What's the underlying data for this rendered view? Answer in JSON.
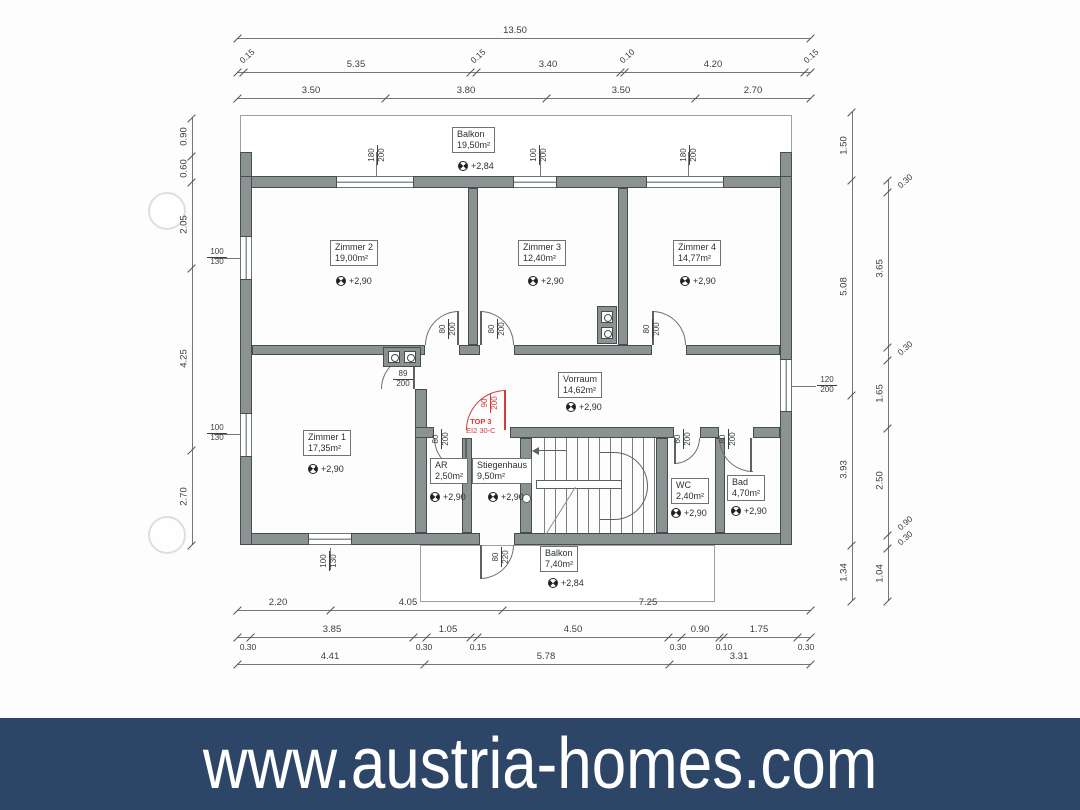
{
  "banner": {
    "text": "www.austria-homes.com",
    "bg_color": "#2d4668",
    "text_color": "#ffffff"
  },
  "colors": {
    "red_accent": "#d43a3a",
    "wall_gray": "#8b9292"
  },
  "rooms": [
    {
      "name": "Balkon",
      "area": "19,50m²",
      "bx": 452,
      "by": 127,
      "lvl": "+2,84",
      "lx": 458,
      "ly": 161
    },
    {
      "name": "Zimmer 2",
      "area": "19,00m²",
      "bx": 330,
      "by": 240,
      "lvl": "+2,90",
      "lx": 336,
      "ly": 276
    },
    {
      "name": "Zimmer 3",
      "area": "12,40m²",
      "bx": 518,
      "by": 240,
      "lvl": "+2,90",
      "lx": 528,
      "ly": 276
    },
    {
      "name": "Zimmer 4",
      "area": "14,77m²",
      "bx": 673,
      "by": 240,
      "lvl": "+2,90",
      "lx": 680,
      "ly": 276
    },
    {
      "name": "Vorraum",
      "area": "14,62m²",
      "bx": 558,
      "by": 372,
      "lvl": "+2,90",
      "lx": 566,
      "ly": 402
    },
    {
      "name": "Zimmer 1",
      "area": "17,35m²",
      "bx": 303,
      "by": 430,
      "lvl": "+2,90",
      "lx": 308,
      "ly": 464
    },
    {
      "name": "AR",
      "area": "2,50m²",
      "bx": 430,
      "by": 458,
      "lvl": "+2,90",
      "lx": 430,
      "ly": 492
    },
    {
      "name": "Stiegenhaus",
      "area": "9,50m²",
      "bx": 472,
      "by": 458,
      "lvl": "+2,90",
      "lx": 488,
      "ly": 492
    },
    {
      "name": "WC",
      "area": "2,40m²",
      "bx": 671,
      "by": 478,
      "lvl": "+2,90",
      "lx": 671,
      "ly": 508
    },
    {
      "name": "Bad",
      "area": "4,70m²",
      "bx": 727,
      "by": 475,
      "lvl": "+2,90",
      "lx": 731,
      "ly": 506
    },
    {
      "name": "Balkon",
      "area": "7,40m²",
      "bx": 540,
      "by": 546,
      "lvl": "+2,84",
      "lx": 548,
      "ly": 578
    }
  ],
  "red_unit": {
    "label_line1": "TOP 3",
    "label_line2": "EI2 30-C",
    "x": 466,
    "y": 417
  },
  "size_labels": [
    {
      "top": "180",
      "bot": "200",
      "x": 366,
      "y": 146,
      "rot": true
    },
    {
      "top": "100",
      "bot": "200",
      "x": 528,
      "y": 146,
      "rot": true
    },
    {
      "top": "180",
      "bot": "200",
      "x": 678,
      "y": 146,
      "rot": true
    },
    {
      "top": "100",
      "bot": "130",
      "x": 206,
      "y": 248
    },
    {
      "top": "100",
      "bot": "130",
      "x": 206,
      "y": 424
    },
    {
      "top": "120",
      "bot": "200",
      "x": 816,
      "y": 376
    },
    {
      "top": "100",
      "bot": "130",
      "x": 318,
      "y": 552,
      "rot": true
    },
    {
      "top": "80",
      "bot": "200",
      "x": 437,
      "y": 320,
      "rot": true
    },
    {
      "top": "80",
      "bot": "200",
      "x": 486,
      "y": 320,
      "rot": true
    },
    {
      "top": "80",
      "bot": "200",
      "x": 641,
      "y": 320,
      "rot": true
    },
    {
      "top": "89",
      "bot": "200",
      "x": 392,
      "y": 370
    },
    {
      "top": "80",
      "bot": "200",
      "x": 430,
      "y": 430,
      "rot": true
    },
    {
      "top": "60",
      "bot": "200",
      "x": 672,
      "y": 430,
      "rot": true
    },
    {
      "top": "80",
      "bot": "200",
      "x": 717,
      "y": 430,
      "rot": true
    },
    {
      "top": "80",
      "bot": "220",
      "x": 490,
      "y": 548,
      "rot": true
    },
    {
      "top": "90",
      "bot": "200",
      "x": 479,
      "y": 394,
      "rot": true,
      "red": true
    }
  ],
  "dims_h": [
    {
      "y": 38,
      "x1": 237,
      "x2": 810,
      "ticks": [
        237,
        810
      ],
      "labels": [
        {
          "v": "13.50",
          "x": 515
        }
      ]
    },
    {
      "y": 72,
      "x1": 237,
      "x2": 810,
      "ticks": [
        237,
        243,
        470,
        476,
        620,
        624,
        804,
        810
      ],
      "labels": [
        {
          "v": "5.35",
          "x": 356
        },
        {
          "v": "3.40",
          "x": 548
        },
        {
          "v": "4.20",
          "x": 713
        },
        {
          "v": "0.15",
          "x": 242,
          "diag": true
        },
        {
          "v": "0.15",
          "x": 473,
          "diag": true
        },
        {
          "v": "0.10",
          "x": 622,
          "diag": true
        },
        {
          "v": "0.15",
          "x": 806,
          "diag": true
        }
      ]
    },
    {
      "y": 98,
      "x1": 237,
      "x2": 810,
      "ticks": [
        237,
        385,
        546,
        695,
        810
      ],
      "labels": [
        {
          "v": "3.50",
          "x": 311
        },
        {
          "v": "3.80",
          "x": 466
        },
        {
          "v": "3.50",
          "x": 621
        },
        {
          "v": "2.70",
          "x": 753
        }
      ]
    },
    {
      "y": 610,
      "x1": 237,
      "x2": 810,
      "ticks": [
        237,
        330,
        502,
        810
      ],
      "labels": [
        {
          "v": "2.20",
          "x": 278
        },
        {
          "v": "4.05",
          "x": 408
        },
        {
          "v": "7.25",
          "x": 648
        }
      ]
    },
    {
      "y": 637,
      "x1": 237,
      "x2": 810,
      "ticks": [
        237,
        250,
        413,
        426,
        470,
        477,
        668,
        681,
        719,
        723,
        797,
        810
      ],
      "labels": [
        {
          "v": "3.85",
          "x": 332
        },
        {
          "v": "1.05",
          "x": 448
        },
        {
          "v": "4.50",
          "x": 573
        },
        {
          "v": "0.90",
          "x": 700
        },
        {
          "v": "1.75",
          "x": 759
        }
      ],
      "subs": [
        {
          "v": "0.30",
          "x": 246
        },
        {
          "v": "0.30",
          "x": 422
        },
        {
          "v": "0.15",
          "x": 476
        },
        {
          "v": "0.30",
          "x": 676
        },
        {
          "v": "0.10",
          "x": 722
        },
        {
          "v": "0.30",
          "x": 804
        }
      ]
    },
    {
      "y": 664,
      "x1": 237,
      "x2": 810,
      "ticks": [
        237,
        424,
        669,
        810
      ],
      "labels": [
        {
          "v": "4.41",
          "x": 330
        },
        {
          "v": "5.78",
          "x": 546
        },
        {
          "v": "3.31",
          "x": 739
        }
      ]
    }
  ],
  "dims_v": [
    {
      "x": 192,
      "y1": 118,
      "y2": 545,
      "ticks": [
        118,
        156,
        182,
        268,
        450,
        545
      ],
      "labels": [
        {
          "v": "0.90",
          "y": 137
        },
        {
          "v": "0.60",
          "y": 169
        },
        {
          "v": "2.05",
          "y": 225
        },
        {
          "v": "4.25",
          "y": 359
        },
        {
          "v": "2.70",
          "y": 497
        }
      ]
    },
    {
      "x": 852,
      "y1": 112,
      "y2": 601,
      "ticks": [
        112,
        180,
        395,
        545,
        601
      ],
      "labels": [
        {
          "v": "1.50",
          "y": 146
        },
        {
          "v": "5.08",
          "y": 287
        },
        {
          "v": "3.93",
          "y": 470
        },
        {
          "v": "1.34",
          "y": 573
        }
      ]
    },
    {
      "x": 888,
      "y1": 180,
      "y2": 601,
      "ticks": [
        180,
        192,
        347,
        360,
        428,
        535,
        548,
        601
      ],
      "labels": [
        {
          "v": "3.65",
          "y": 269
        },
        {
          "v": "1.65",
          "y": 394
        },
        {
          "v": "2.50",
          "y": 481
        },
        {
          "v": "1.04",
          "y": 574
        },
        {
          "v": "0.30",
          "y": 186,
          "diag": true
        },
        {
          "v": "0.30",
          "y": 353,
          "diag": true
        },
        {
          "v": "0.90",
          "y": 528,
          "diag": true
        },
        {
          "v": "0.30",
          "y": 543,
          "diag": true
        }
      ]
    }
  ]
}
